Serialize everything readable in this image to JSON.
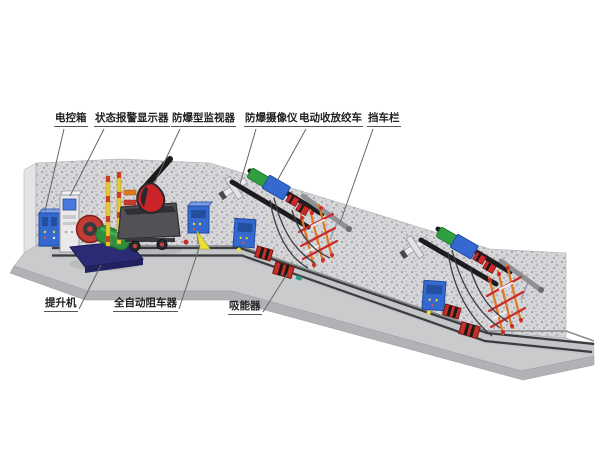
{
  "callouts": {
    "top": [
      {
        "id": "electric-control-box",
        "label": "电控箱"
      },
      {
        "id": "status-alarm-display",
        "label": "状态报警显示器"
      },
      {
        "id": "explosion-proof-monitor",
        "label": "防爆型监视器"
      },
      {
        "id": "explosion-proof-camera",
        "label": "防爆摄像仪"
      },
      {
        "id": "electric-winch",
        "label": "电动收放绞车"
      },
      {
        "id": "car-blocking-barrier",
        "label": "挡车栏"
      }
    ],
    "bottom": [
      {
        "id": "hoist-machine",
        "label": "提升机"
      },
      {
        "id": "auto-car-blocker",
        "label": "全自动阻车器"
      },
      {
        "id": "energy-absorber",
        "label": "吸能器"
      }
    ]
  },
  "colors": {
    "background": "#ffffff",
    "wall_base": "#d8d8da",
    "wall_speckle": "#a0a0a8",
    "floor_top": "#c9cbcd",
    "floor_edge": "#b0b2b5",
    "rail_dark": "#3b3b40",
    "equipment_blue": "#3569cf",
    "alarm_red": "#c23028",
    "motor_green": "#2f8f3f",
    "hoist_base_navy": "#2b2b76",
    "barrier_orange": "#e07820",
    "barrier_red": "#cc2a2a",
    "beam_black": "#1c1c1e",
    "beam_gray": "#8e9094",
    "warning_yellow": "#e8e232",
    "label_text": "#222222",
    "leader_line": "#666666"
  }
}
